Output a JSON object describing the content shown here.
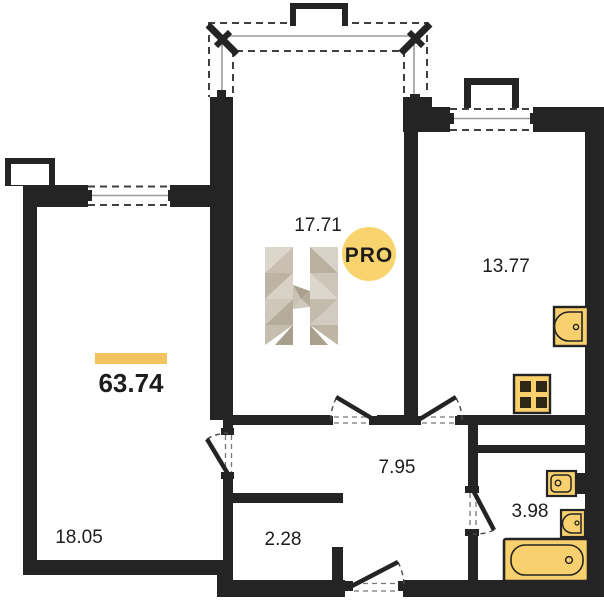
{
  "plan": {
    "type": "apartment-floor-plan",
    "total_area": "63.74",
    "rooms": [
      {
        "name": "living-room",
        "area": "17.71"
      },
      {
        "name": "kitchen",
        "area": "13.77"
      },
      {
        "name": "bedroom",
        "area": "18.05"
      },
      {
        "name": "hallway",
        "area": "7.95"
      },
      {
        "name": "closet",
        "area": "2.28"
      },
      {
        "name": "bathroom",
        "area": "3.98"
      }
    ],
    "watermark": {
      "badge": "PRO",
      "logo_letter": "H"
    },
    "fixtures": [
      "kitchen-sink",
      "stove",
      "washbasin",
      "toilet",
      "bathtub"
    ],
    "colors": {
      "wall": "#242424",
      "accent_bar": "#f2c45f",
      "fixture_fill": "#f8d06d",
      "badge_fill": "#f9d36e",
      "badge_text": "#a59e8e",
      "dash_line": "#3f3f3f",
      "glazing_line": "#9b9b9b"
    }
  }
}
